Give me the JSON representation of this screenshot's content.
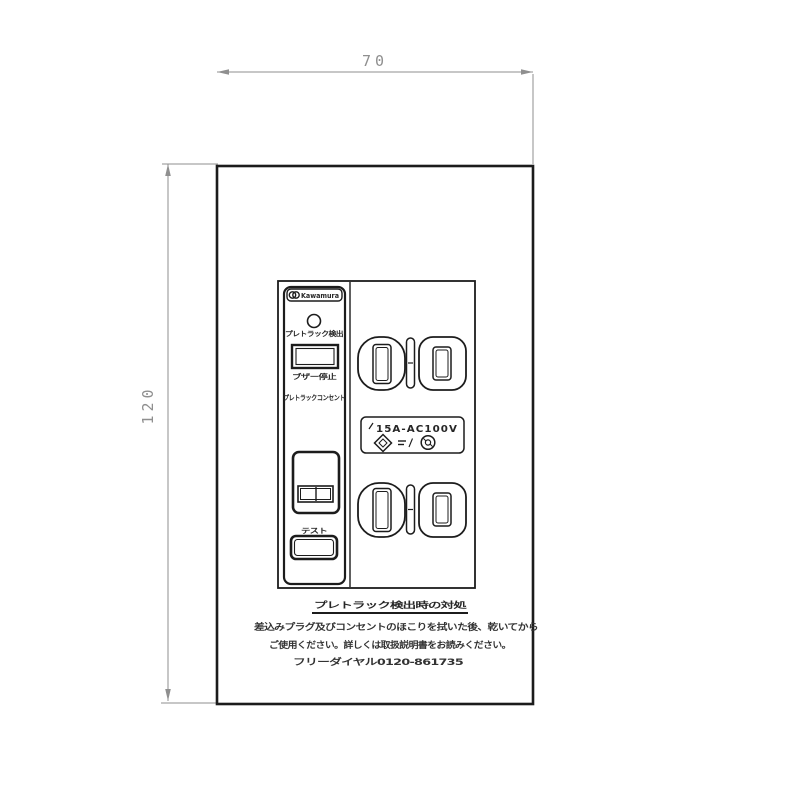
{
  "drawing": {
    "title": "tracking-detection outlet technical drawing",
    "dimensions": {
      "width_label": "70",
      "height_label": "120"
    },
    "device": {
      "brand": "Kawamura",
      "indicator_label": "プレトラック検出",
      "buzzer_button_label": "ブザー停止",
      "strip_label": "プレトラックコンセント",
      "test_label": "テスト",
      "rating": "15A-AC100V"
    },
    "caption": {
      "heading": "プレトラック検出時の対処",
      "line1": "差込みプラグ及びコンセントのほこりを拭いた後、乾いてから",
      "line2": "ご使用ください。詳しくは取扱説明書をお読みください。",
      "line3": "フリーダイヤル0120-861735"
    },
    "colors": {
      "line": "#1c1c1c",
      "dimension": "#8f8f8f",
      "text": "#262626"
    }
  }
}
